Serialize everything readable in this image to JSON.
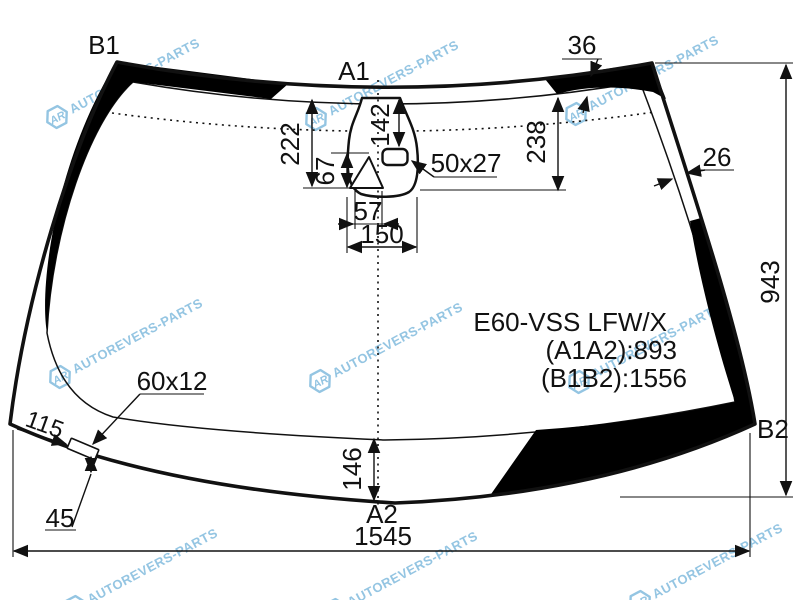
{
  "labels": {
    "b1": "B1",
    "a1": "A1",
    "a2": "A2",
    "b2": "B2"
  },
  "dimensions": {
    "top_band_width": "36",
    "side_band_width": "26",
    "height_right": "943",
    "width_bottom": "1545",
    "bottom_edge_to_band": "146",
    "left_sensor_drop": "222",
    "center_sensor_drop": "142",
    "right_sensor_drop": "238",
    "bracket_height": "67",
    "bracket_width": "57",
    "mount_width": "150",
    "sensor_window_size": "50x27",
    "bottom_mark_size": "60x12",
    "corner_edge_length": "115",
    "corner_mark_offset": "45"
  },
  "part_info": {
    "model": "E60-VSS LFW/X",
    "a1a2": "(A1A2):893",
    "b1b2": "(B1B2):1556"
  },
  "watermark": {
    "logo_text": "AR",
    "brand_text": "AUTOREVERS-PARTS",
    "color": "#3d96cc"
  },
  "colors": {
    "line": "#111111",
    "band_fill": "#000000",
    "background": "#ffffff"
  }
}
